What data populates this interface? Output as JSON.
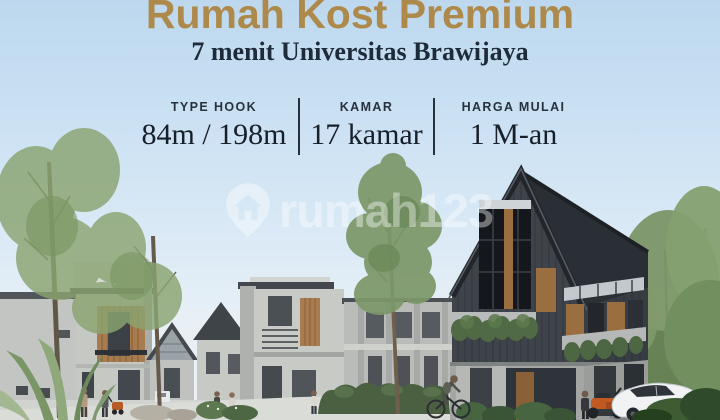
{
  "header": {
    "title": "Rumah Kost Premium",
    "subtitle": "7 menit Universitas Brawijaya"
  },
  "info": {
    "columns": [
      {
        "label": "TYPE HOOK",
        "value": "84m / 198m"
      },
      {
        "label": "KAMAR",
        "value": "17 kamar"
      },
      {
        "label": "HARGA MULAI",
        "value": "1 M-an"
      }
    ]
  },
  "watermark": {
    "icon": "map-pin-house-icon",
    "text": "rumah123"
  },
  "colors": {
    "title_gold": "#ad8a4b",
    "text_navy": "#1e2b3a",
    "sky_top": "#bdd8ee",
    "sky_horizon": "#eef4f8",
    "dark_house": "#3f444b",
    "wood_accent": "#a87c4e",
    "grey_house": "#c6c8c4",
    "hedge_green": "#4b6040",
    "scooter_orange": "#c05a22",
    "car_white": "#f0f2f3"
  },
  "scene": {
    "description": "3D render of a premium kost housing cluster: rows of grey two-storey townhouses with wood-slat balconies along a street with pedestrians and a cyclist, a large dark charcoal gable-roof corner house with wood window panels and green planter boxes, a white sedan and an orange scooter parked in front, trees and agave plants in the foreground"
  }
}
